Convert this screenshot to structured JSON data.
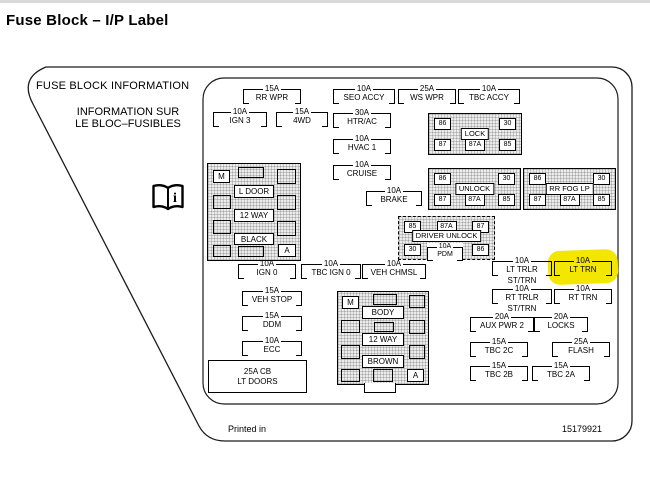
{
  "page": {
    "title": "Fuse Block – I/P Label"
  },
  "label": {
    "heading_en": "FUSE BLOCK INFORMATION",
    "heading_fr_line1": "INFORMATION SUR",
    "heading_fr_line2": "LE BLOC–FUSIBLES",
    "printed_in": "Printed in",
    "part_number": "15179921",
    "highlight_color": "#f3e600"
  },
  "icons": {
    "book": "open-book-info-icon"
  },
  "fuses": {
    "rr_wpr": {
      "amp": "15A",
      "name": "RR WPR"
    },
    "seo_accy": {
      "amp": "10A",
      "name": "SEO ACCY"
    },
    "ws_wpr": {
      "amp": "25A",
      "name": "WS WPR"
    },
    "tbc_accy": {
      "amp": "10A",
      "name": "TBC ACCY"
    },
    "ign_3": {
      "amp": "10A",
      "name": "IGN 3"
    },
    "four_wd": {
      "amp": "15A",
      "name": "4WD"
    },
    "htr_ac": {
      "amp": "30A",
      "name": "HTR/AC"
    },
    "hvac_1": {
      "amp": "10A",
      "name": "HVAC 1"
    },
    "cruise": {
      "amp": "10A",
      "name": "CRUISE"
    },
    "brake": {
      "amp": "10A",
      "name": "BRAKE"
    },
    "ign_0": {
      "amp": "10A",
      "name": "IGN 0"
    },
    "tbc_ign_0": {
      "amp": "10A",
      "name": "TBC IGN 0"
    },
    "veh_chmsl": {
      "amp": "10A",
      "name": "VEH CHMSL"
    },
    "veh_stop": {
      "amp": "15A",
      "name": "VEH STOP"
    },
    "ddm": {
      "amp": "15A",
      "name": "DDM"
    },
    "ecc": {
      "amp": "10A",
      "name": "ECC"
    },
    "lt_trlr": {
      "amp": "10A",
      "name": "LT TRLR",
      "sub": "ST/TRN"
    },
    "lt_trn": {
      "amp": "10A",
      "name": "LT TRN",
      "highlighted": true
    },
    "rt_trlr": {
      "amp": "10A",
      "name": "RT TRLR",
      "sub": "ST/TRN"
    },
    "rt_trn": {
      "amp": "10A",
      "name": "RT TRN"
    },
    "aux_pwr_2": {
      "amp": "20A",
      "name": "AUX PWR 2"
    },
    "locks": {
      "amp": "20A",
      "name": "LOCKS"
    },
    "tbc_2c": {
      "amp": "15A",
      "name": "TBC 2C"
    },
    "flash": {
      "amp": "25A",
      "name": "FLASH"
    },
    "tbc_2b": {
      "amp": "15A",
      "name": "TBC 2B"
    },
    "tbc_2a": {
      "amp": "15A",
      "name": "TBC 2A"
    }
  },
  "relays": {
    "lock": {
      "label": "LOCK",
      "pins": [
        "86",
        "30",
        "87",
        "87A",
        "85"
      ]
    },
    "unlock": {
      "label": "UNLOCK",
      "pins": [
        "86",
        "30",
        "87",
        "87A",
        "85"
      ]
    },
    "rr_fog_lp": {
      "label": "RR FOG LP",
      "pins": [
        "86",
        "30",
        "87",
        "87A",
        "85"
      ]
    },
    "driver_unlock": {
      "label": "DRIVER UNLOCK",
      "pins": [
        "85",
        "87A",
        "87",
        "30",
        "86"
      ],
      "fuse": {
        "amp": "10A",
        "name": "PDM"
      }
    }
  },
  "connectors": {
    "l_door": {
      "corner_top": "M",
      "corner_bottom": "A",
      "labels": [
        "L DOOR",
        "12 WAY",
        "BLACK"
      ]
    },
    "body": {
      "corner_top": "M",
      "corner_bottom": "A",
      "labels": [
        "BODY",
        "12 WAY",
        "BROWN"
      ]
    }
  },
  "breaker": {
    "amp": "25A CB",
    "name": "LT DOORS"
  }
}
